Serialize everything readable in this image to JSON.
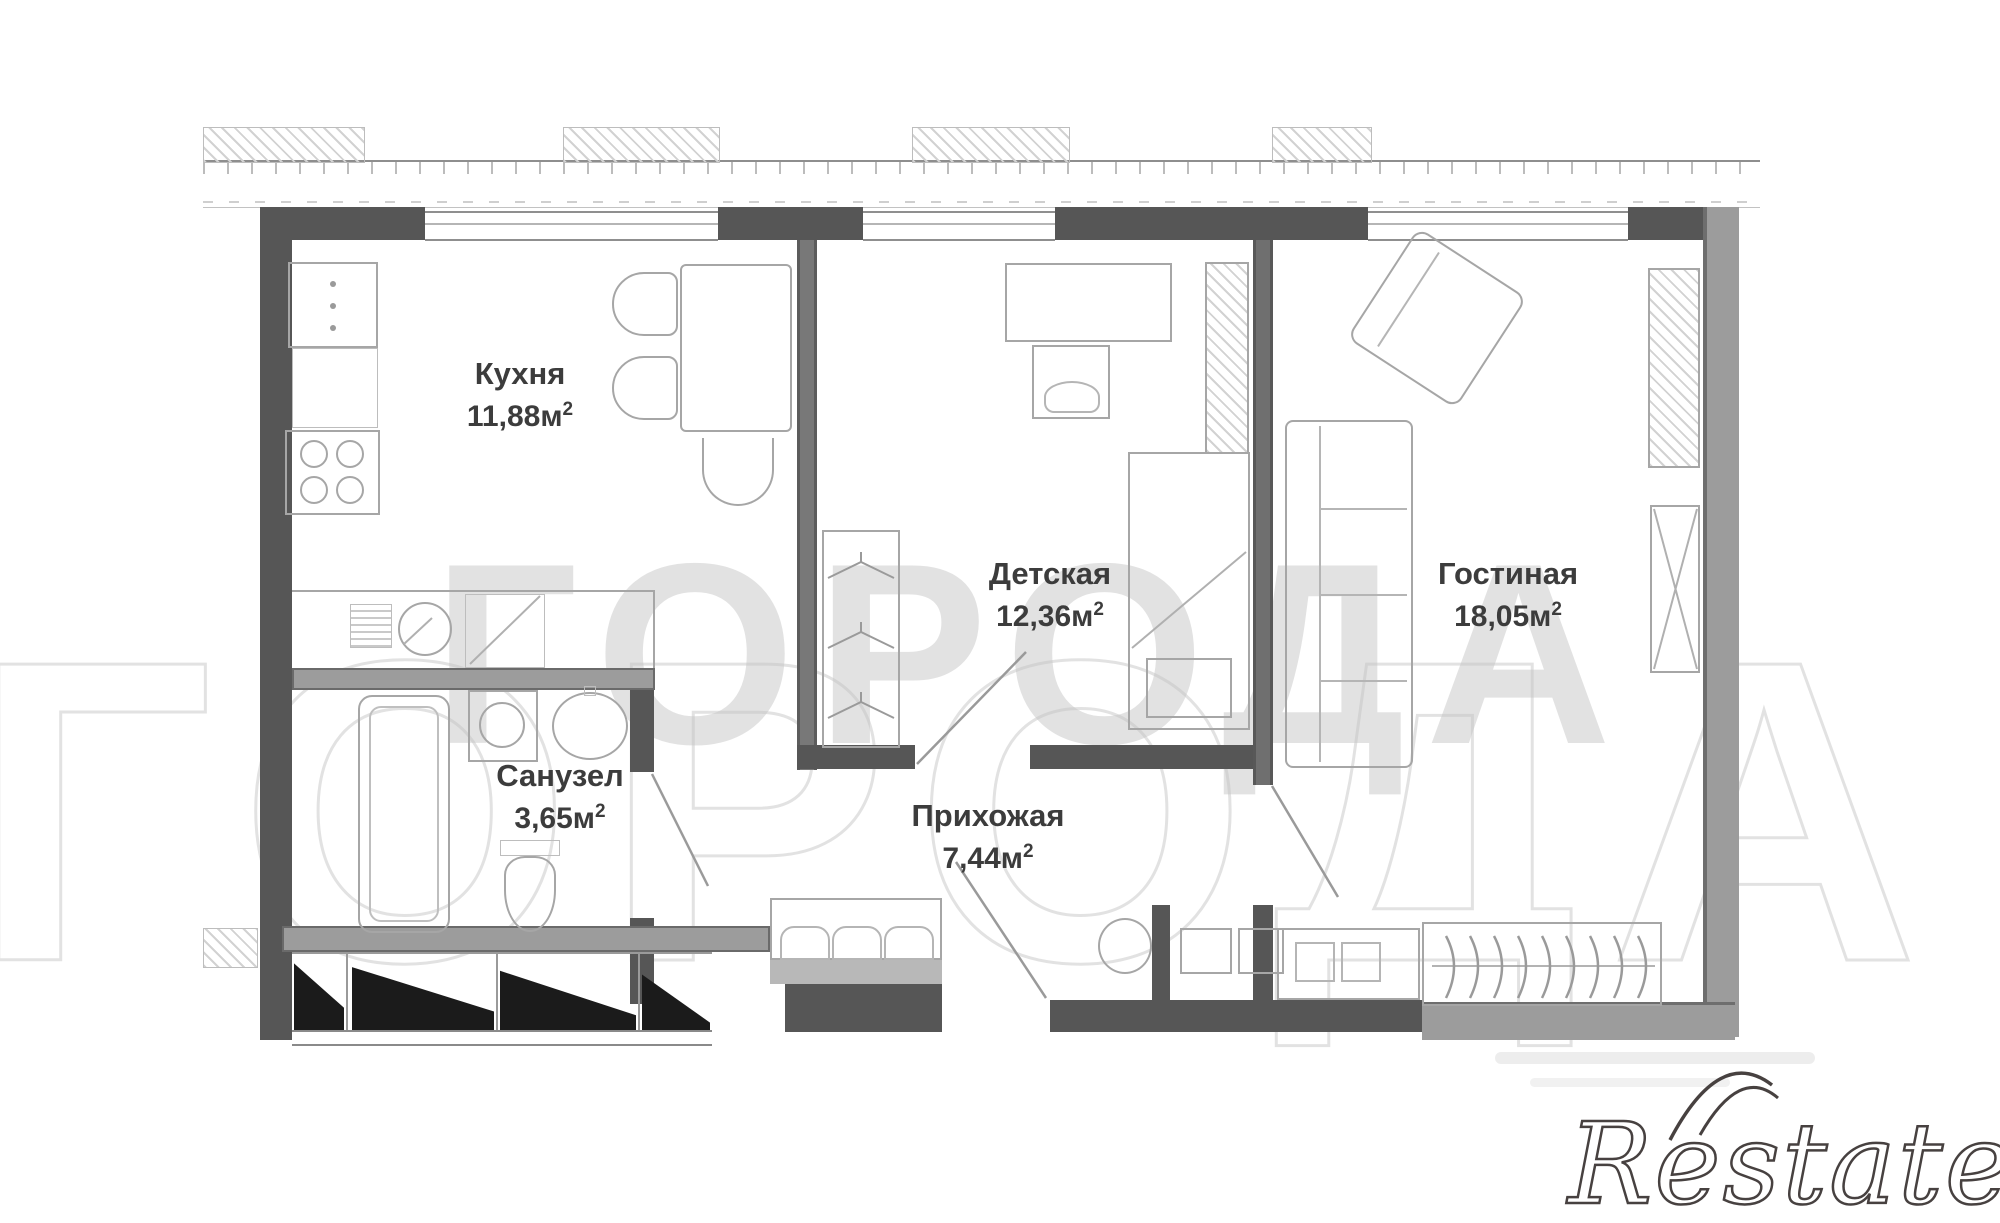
{
  "rooms": [
    {
      "name": "Кухня",
      "area": "11,88м",
      "sup": "2"
    },
    {
      "name": "Детская",
      "area": "12,36м",
      "sup": "2"
    },
    {
      "name": "Гостиная",
      "area": "18,05м",
      "sup": "2"
    },
    {
      "name": "Санузел",
      "area": "3,65м",
      "sup": "2"
    },
    {
      "name": "Прихожая",
      "area": "7,44м",
      "sup": "2"
    }
  ],
  "watermarks": {
    "center_text": "ГОРОДА",
    "outline_text": "ГОРОДА",
    "brand_text": "Restate"
  },
  "colors": {
    "wall_dark": "#565656",
    "wall_medium": "#9c9c9c",
    "furniture_line": "#a6a6a6",
    "label_text": "#3c3c3c",
    "watermark_gray": "#c6c6c6",
    "brand_outline": "#474140"
  }
}
